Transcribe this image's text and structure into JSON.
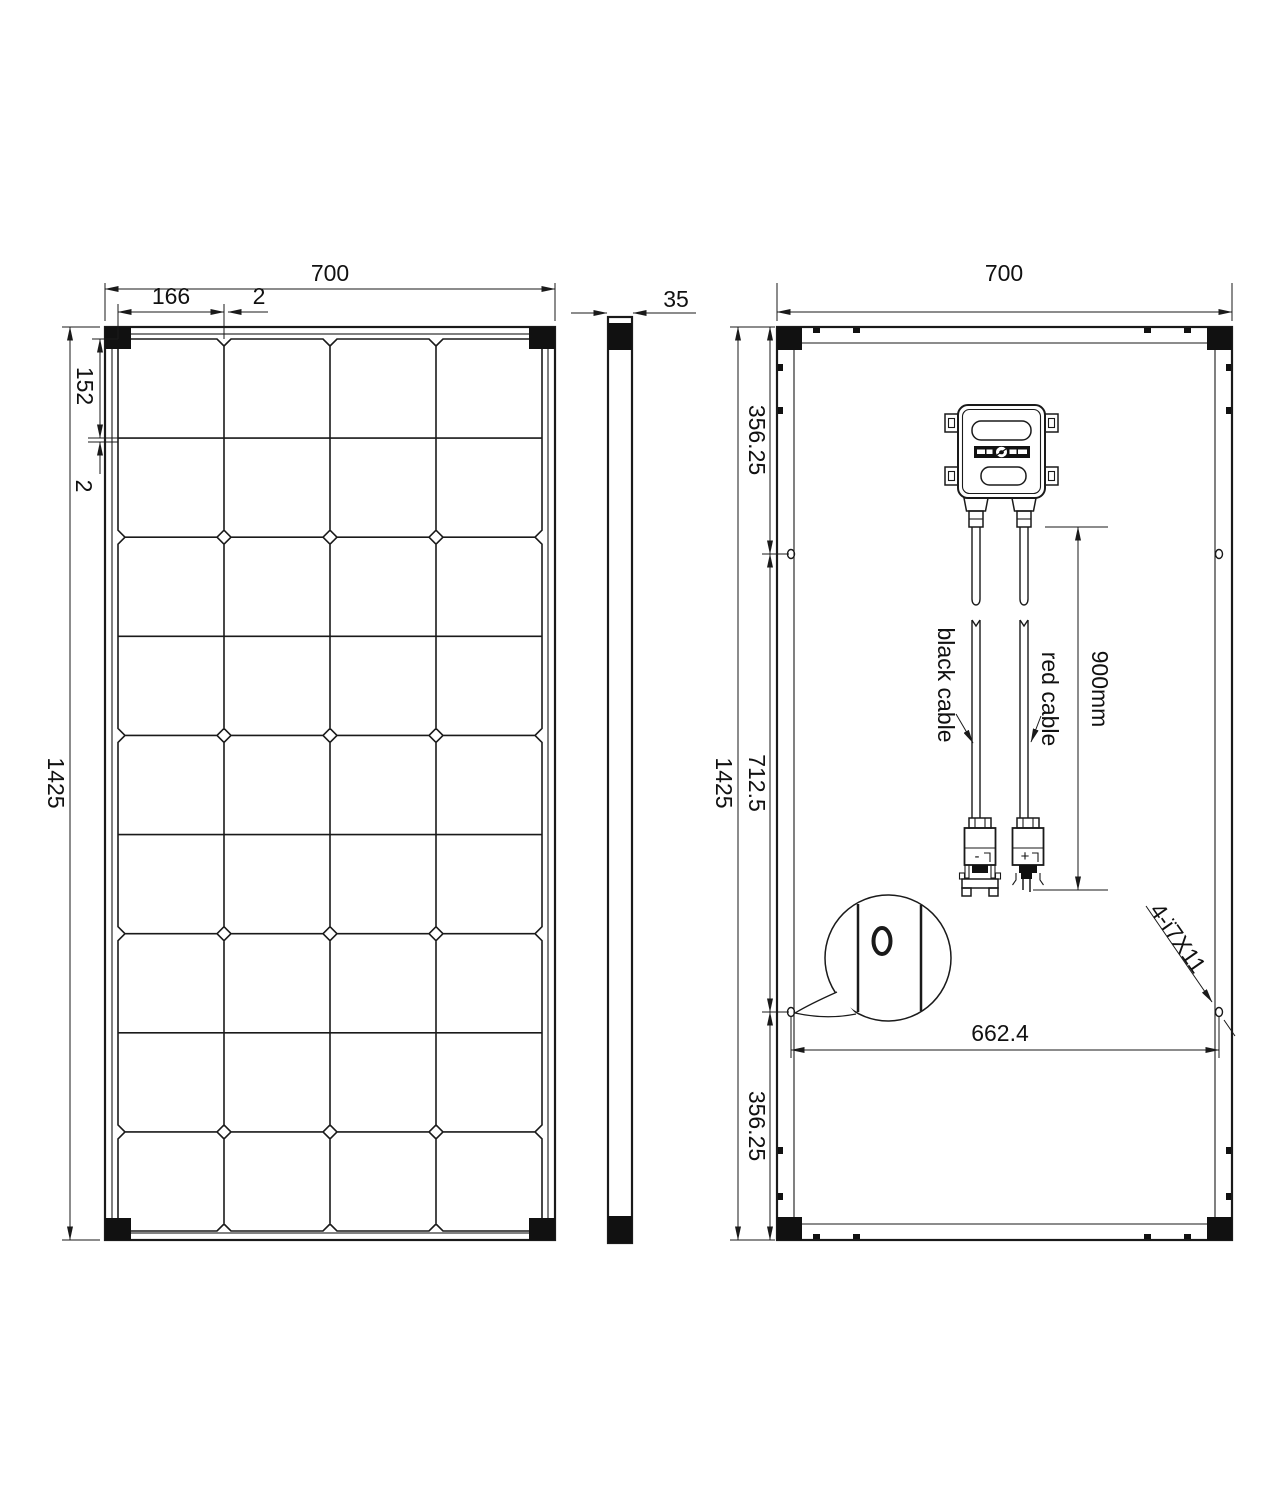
{
  "front": {
    "dim_width": "700",
    "dim_cell_w": "166",
    "dim_gap_top": "2",
    "dim_cell_h": "152",
    "dim_gap_left": "2",
    "dim_height": "1425",
    "grid": {
      "cols": 4,
      "rows": 9
    }
  },
  "side": {
    "dim_thickness": "35"
  },
  "back": {
    "dim_width": "700",
    "dim_height": "1425",
    "dim_top_offset": "356.25",
    "dim_middle": "712.5",
    "dim_bottom_offset": "356.25",
    "dim_hole_spacing": "662.4",
    "dim_cable_length": "900mm",
    "hole_note": "4-ï7X11",
    "label_black_cable": "black cable",
    "label_red_cable": "red cable",
    "label_minus": "-",
    "label_plus": "+"
  },
  "colors": {
    "line": "#1a1a1a",
    "background": "#ffffff"
  }
}
